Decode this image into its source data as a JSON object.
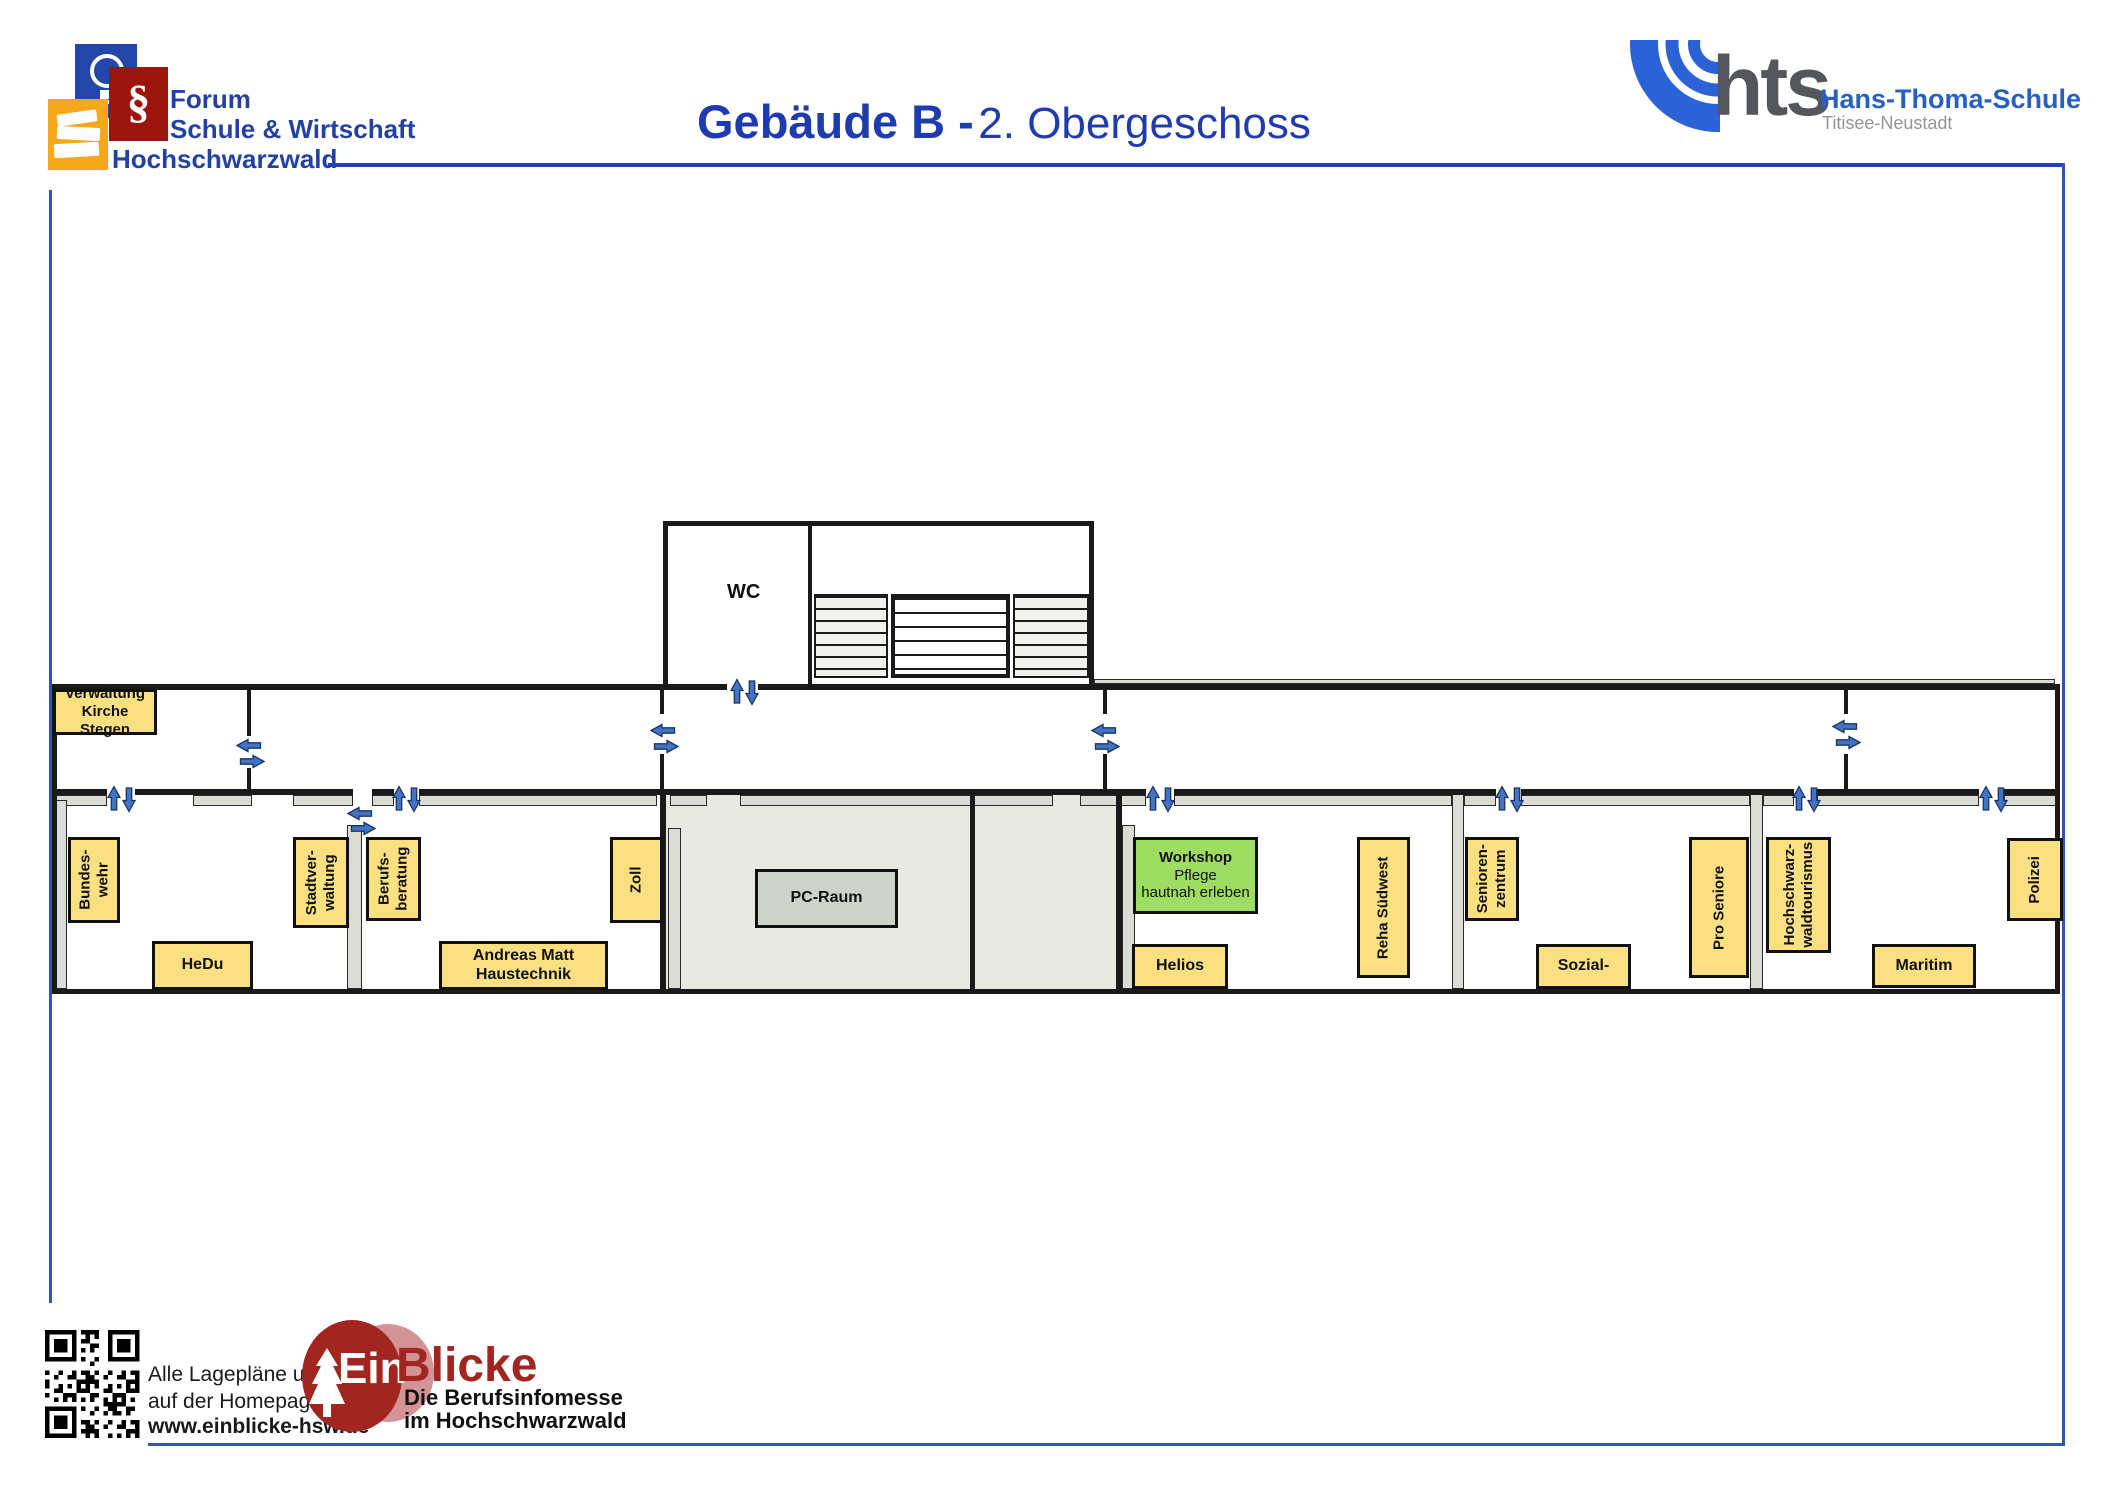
{
  "header": {
    "forum_logo": {
      "line1": "Forum",
      "line2": "Schule & Wirtschaft",
      "line3": "Hochschwarzwald",
      "paragraph_symbol": "§"
    },
    "title": {
      "bold": "Gebäude B -",
      "regular": "2. Obergeschoss"
    },
    "hts_logo": {
      "abbr": "hts",
      "name": "Hans-Thoma-Schule",
      "subtitle": "Titisee-Neustadt"
    }
  },
  "plan": {
    "wc_label": "WC",
    "room_labels": [
      {
        "id": "verwaltung-kirche-stegen",
        "lines": [
          "Verwaltung",
          "Kirche Stegen"
        ],
        "style": "yellow",
        "orient": "h",
        "x": 53,
        "y": 689,
        "w": 104,
        "h": 46,
        "font": 15
      },
      {
        "id": "bundeswehr",
        "lines": [
          "Bundes-",
          "wehr"
        ],
        "style": "yellow",
        "orient": "v",
        "x": 68,
        "y": 837,
        "w": 52,
        "h": 86
      },
      {
        "id": "hedu",
        "lines": [
          "HeDu"
        ],
        "style": "yellow",
        "orient": "h",
        "x": 152,
        "y": 941,
        "w": 101,
        "h": 49
      },
      {
        "id": "stadtverwaltung",
        "lines": [
          "Stadtver-",
          "waltung"
        ],
        "style": "yellow",
        "orient": "v",
        "x": 293,
        "y": 837,
        "w": 56,
        "h": 91
      },
      {
        "id": "berufsberatung",
        "lines": [
          "Berufs-",
          "beratung"
        ],
        "style": "yellow",
        "orient": "v",
        "x": 366,
        "y": 837,
        "w": 55,
        "h": 84
      },
      {
        "id": "andreas-matt-haustechnik",
        "lines": [
          "Andreas Matt",
          "Haustechnik"
        ],
        "style": "yellow",
        "orient": "h",
        "x": 439,
        "y": 941,
        "w": 169,
        "h": 49
      },
      {
        "id": "zoll",
        "lines": [
          "Zoll"
        ],
        "style": "yellow",
        "orient": "v",
        "x": 610,
        "y": 837,
        "w": 53,
        "h": 86
      },
      {
        "id": "pc-raum",
        "lines": [
          "PC-Raum"
        ],
        "style": "grayb",
        "orient": "h",
        "x": 755,
        "y": 869,
        "w": 143,
        "h": 59
      },
      {
        "id": "workshop-pflege",
        "lines": [
          "Workshop Pflege",
          "hautnah erleben"
        ],
        "style": "green",
        "orient": "h",
        "x": 1133,
        "y": 837,
        "w": 125,
        "h": 77,
        "bold_first": true
      },
      {
        "id": "helios",
        "lines": [
          "Helios"
        ],
        "style": "yellow",
        "orient": "h",
        "x": 1132,
        "y": 944,
        "w": 96,
        "h": 45
      },
      {
        "id": "reha-suedwest",
        "lines": [
          "Reha Südwest"
        ],
        "style": "yellow",
        "orient": "v",
        "x": 1357,
        "y": 837,
        "w": 53,
        "h": 141
      },
      {
        "id": "seniorenzentrum",
        "lines": [
          "Senioren-",
          "zentrum"
        ],
        "style": "yellow",
        "orient": "v",
        "x": 1465,
        "y": 837,
        "w": 54,
        "h": 84
      },
      {
        "id": "sozial",
        "lines": [
          "Sozial-"
        ],
        "style": "yellow",
        "orient": "h",
        "x": 1536,
        "y": 944,
        "w": 95,
        "h": 45
      },
      {
        "id": "pro-seniore",
        "lines": [
          "Pro Seniore"
        ],
        "style": "yellow",
        "orient": "v",
        "x": 1689,
        "y": 837,
        "w": 60,
        "h": 141
      },
      {
        "id": "hochschwarzwaldtourismus",
        "lines": [
          "Hochschwarz-",
          "waldtourismus"
        ],
        "style": "yellow",
        "orient": "v",
        "x": 1766,
        "y": 837,
        "w": 65,
        "h": 116
      },
      {
        "id": "maritim",
        "lines": [
          "Maritim"
        ],
        "style": "yellow",
        "orient": "h",
        "x": 1872,
        "y": 944,
        "w": 104,
        "h": 44
      },
      {
        "id": "polizei",
        "lines": [
          "Polizei"
        ],
        "style": "yellow",
        "orient": "v",
        "x": 2007,
        "y": 838,
        "w": 56,
        "h": 83
      }
    ],
    "door_arrows": [
      {
        "dir": "left",
        "x": 249,
        "y": 745
      },
      {
        "dir": "right",
        "x": 252,
        "y": 761
      },
      {
        "dir": "left",
        "x": 663,
        "y": 730
      },
      {
        "dir": "right",
        "x": 666,
        "y": 746
      },
      {
        "dir": "left",
        "x": 1104,
        "y": 730
      },
      {
        "dir": "right",
        "x": 1107,
        "y": 746
      },
      {
        "dir": "left",
        "x": 1845,
        "y": 726
      },
      {
        "dir": "right",
        "x": 1848,
        "y": 742
      },
      {
        "dir": "left",
        "x": 360,
        "y": 813
      },
      {
        "dir": "right",
        "x": 363,
        "y": 828
      },
      {
        "dir": "up",
        "x": 114,
        "y": 798
      },
      {
        "dir": "down",
        "x": 129,
        "y": 799
      },
      {
        "dir": "up",
        "x": 399,
        "y": 798
      },
      {
        "dir": "down",
        "x": 414,
        "y": 799
      },
      {
        "dir": "up",
        "x": 1153,
        "y": 798
      },
      {
        "dir": "down",
        "x": 1168,
        "y": 799
      },
      {
        "dir": "up",
        "x": 1502,
        "y": 798
      },
      {
        "dir": "down",
        "x": 1517,
        "y": 799
      },
      {
        "dir": "up",
        "x": 1799,
        "y": 798
      },
      {
        "dir": "down",
        "x": 1814,
        "y": 799
      },
      {
        "dir": "up",
        "x": 1986,
        "y": 798
      },
      {
        "dir": "down",
        "x": 2001,
        "y": 799
      },
      {
        "dir": "up",
        "x": 737,
        "y": 691
      },
      {
        "dir": "down",
        "x": 752,
        "y": 692
      }
    ]
  },
  "footer": {
    "note_line1": "Alle Lagepläne und Infos",
    "note_line2": "auf der Homepage",
    "note_line3": "www.einblicke-hsw.de",
    "einblicke": {
      "brand_white": "Ein",
      "brand_red": "Blicke",
      "sub_line1": "Die Berufsinfomesse",
      "sub_line2": "im Hochschwarzwald"
    }
  },
  "colors": {
    "title_blue": "#1e3cb0",
    "frame_blue": "#3355bb",
    "forum_text_blue": "#2141a5",
    "forum_square_blue": "#2346a8",
    "forum_square_red": "#9b150c",
    "forum_square_yellow": "#f6a81c",
    "hts_blue": "#2b62d6",
    "hts_gray": "#53565a",
    "label_yellow": "#fbe081",
    "label_green": "#9edc62",
    "label_gray": "#cdd3c8",
    "room_fill_gray": "#e8e9e3",
    "wall_gray": "#dcdcd7",
    "arrow_blue": "#4472c4",
    "einblicke_dark_red": "#a1261f",
    "einblicke_light_red": "#d49396"
  }
}
